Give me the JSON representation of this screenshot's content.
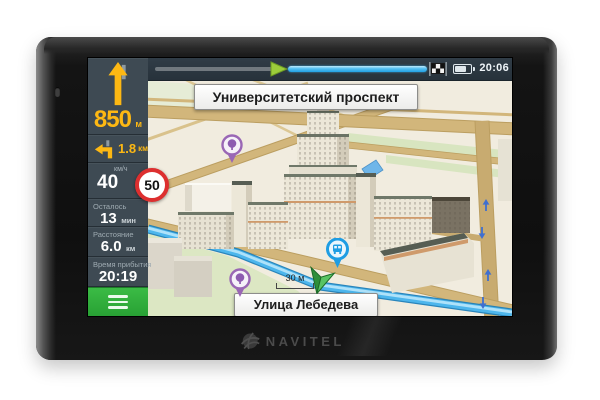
{
  "device": {
    "brand": "NAVITEL"
  },
  "statusbar": {
    "time": "20:06"
  },
  "sidebar": {
    "maneuver_primary": {
      "icon": "straight-ahead-arrow-icon",
      "distance": "850",
      "unit": "м"
    },
    "maneuver_secondary": {
      "icon": "turn-left-arrow-icon",
      "distance": "1.8",
      "unit": "км"
    },
    "speed": {
      "unit_label": "км/ч",
      "value": "40"
    },
    "speed_limit": {
      "value": "50"
    },
    "stats": [
      {
        "label": "Осталось",
        "value": "13",
        "unit": "мин"
      },
      {
        "label": "Расстояние",
        "value": "6.0",
        "unit": "км"
      },
      {
        "label": "Время прибытия",
        "value": "20:19",
        "unit": ""
      }
    ]
  },
  "map": {
    "street_top": "Университетский проспект",
    "street_bottom": "Улица Лебедева",
    "scale": "30 м",
    "pois": [
      "park-tree-pin",
      "park-tree-pin",
      "transport-stop-pin"
    ]
  },
  "icons": [
    "straight-ahead-arrow-icon",
    "turn-left-arrow-icon",
    "speed-limit-sign",
    "hamburger-menu-icon",
    "route-progress-position-arrow-icon",
    "checkered-finish-flag-icon",
    "battery-icon",
    "park-tree-pin-icon",
    "transport-stop-pin-icon",
    "gps-cursor-icon",
    "navitel-globe-icon"
  ],
  "colors": {
    "accent_yellow": "#fdb813",
    "menu_green": "#2fae3d",
    "route_blue": "#4db6ec",
    "progress_blue": "#2da7e8",
    "speed_limit_red": "#dd2f2f",
    "sidebar_bg": "#3e4a53",
    "topbar_bg": "#2b3741",
    "map_bg": "#f1ecdf",
    "park_green": "#dce7c3",
    "road_tan": "#d2b67b"
  }
}
